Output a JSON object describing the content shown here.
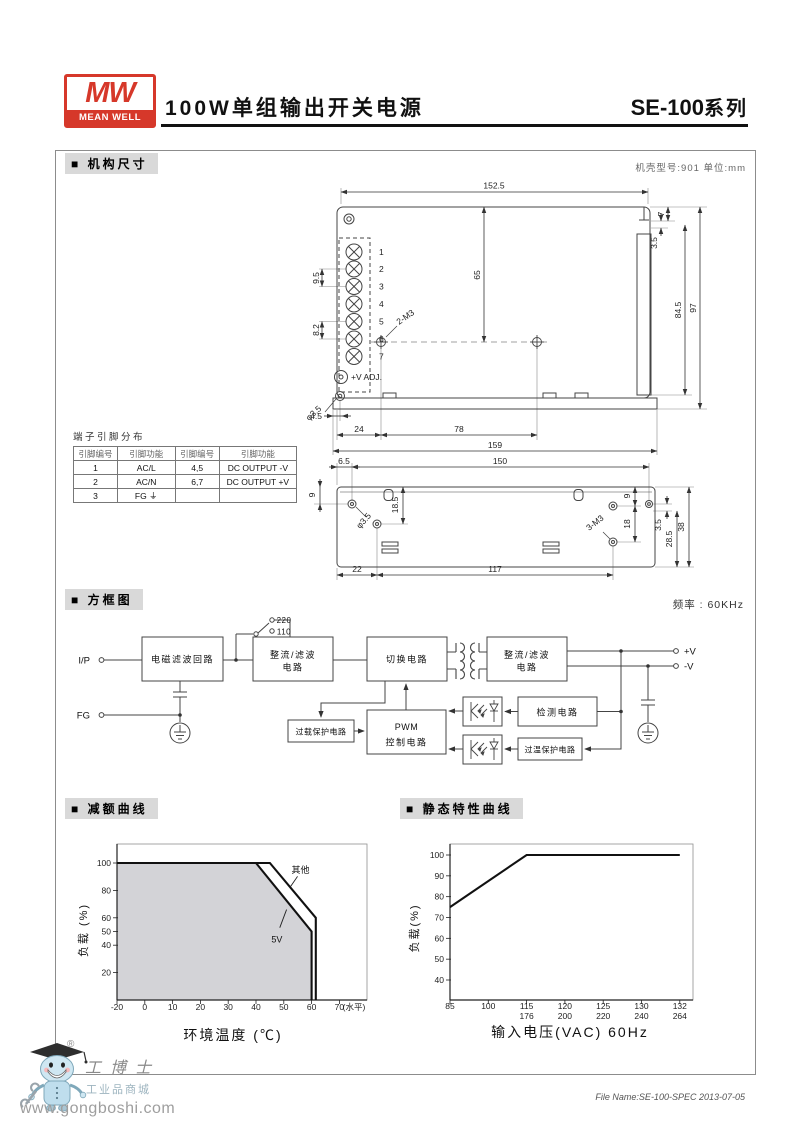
{
  "header": {
    "logo_mw": "MW",
    "logo_brand": "MEAN WELL",
    "logo_color": "#d6382a",
    "title": "100W单组输出开关电源",
    "series_model": "SE-100",
    "series_suffix": "系列"
  },
  "sections": {
    "mech": "■ 机构尺寸",
    "block": "■ 方框图",
    "derating": "■ 减额曲线",
    "static": "■ 静态特性曲线"
  },
  "mech": {
    "case_note": "机壳型号:901   单位:mm",
    "top_view": {
      "dims": {
        "w": "152.5",
        "h65": "65",
        "p95": "9.5",
        "p82": "8.2",
        "m45": "4.5",
        "m24": "24",
        "m78": "78",
        "m159": "159",
        "r7": "7",
        "r35": "3.5",
        "r845": "84.5",
        "r97": "97"
      },
      "labels": {
        "m3": "2-M3",
        "vadj": "+V ADJ.",
        "hole": "φ3.5"
      },
      "pins": [
        "1",
        "2",
        "3",
        "4",
        "5",
        "6",
        "7"
      ]
    },
    "pin_table": {
      "title": "端子引脚分布",
      "headers": [
        "引脚编号",
        "引脚功能",
        "引脚编号",
        "引脚功能"
      ],
      "rows": [
        [
          "1",
          "AC/L",
          "4,5",
          "DC OUTPUT -V"
        ],
        [
          "2",
          "AC/N",
          "6,7",
          "DC OUTPUT +V"
        ],
        [
          "3",
          "FG ⏚",
          "",
          ""
        ]
      ]
    },
    "side_view": {
      "dims": {
        "l65": "6.5",
        "w150": "150",
        "l9": "9",
        "l185": "18.5",
        "r9": "9",
        "r18": "18",
        "r35": "3.5",
        "r285": "28.5",
        "r38": "38",
        "b22": "22",
        "b117": "117"
      },
      "labels": {
        "hole": "φ3.5",
        "m3": "3-M3"
      }
    }
  },
  "block": {
    "frequency": "频率 : 60KHz",
    "sw_220": "220",
    "sw_110": "110",
    "t_ip": "I/P",
    "t_fg": "FG",
    "t_vp": "+V",
    "t_vm": "-V",
    "emi": "电磁滤波回路",
    "rect1a": "整流/滤波",
    "rect1b": "电路",
    "sw": "切换电路",
    "rect2a": "整流/滤波",
    "rect2b": "电路",
    "overload": "过载保护电路",
    "pwma": "PWM",
    "pwmb": "控制电路",
    "detect": "检测电路",
    "otp": "过温保护电路"
  },
  "chart_data": [
    {
      "type": "area",
      "title": "减额曲线",
      "xlabel": "环境温度 (℃)",
      "ylabel": "负载 (%)",
      "x_suffix": "(水平)",
      "xticks": [
        -20,
        0,
        10,
        20,
        30,
        40,
        50,
        60,
        70
      ],
      "yticks": [
        20,
        40,
        50,
        60,
        80,
        100
      ],
      "ylim": [
        0,
        100
      ],
      "grid": false,
      "legend_position": "inline",
      "series": [
        {
          "name": "5V",
          "points": [
            [
              -20,
              100
            ],
            [
              40,
              100
            ],
            [
              60,
              50
            ],
            [
              60,
              0
            ]
          ],
          "fill": "#d3d3d7"
        },
        {
          "name": "其他",
          "points": [
            [
              -20,
              100
            ],
            [
              45,
              100
            ],
            [
              61.5,
              60
            ],
            [
              61.5,
              0
            ]
          ],
          "fill": null
        }
      ],
      "annotations": [
        {
          "text": "其他",
          "x": 56,
          "y": 95,
          "tipx": 52.5,
          "tipy": 83
        },
        {
          "text": "5V",
          "x": 47.5,
          "y": 44,
          "tipx": 51,
          "tipy": 66
        }
      ]
    },
    {
      "type": "line",
      "title": "静态特性曲线",
      "xlabel": "输入电压(VAC) 60Hz",
      "ylabel": "负载(%)",
      "xticks": [
        85,
        100,
        115,
        120,
        125,
        130,
        132
      ],
      "xticks_sub": [
        "",
        "",
        "176",
        "200",
        "220",
        "240",
        "264"
      ],
      "yticks": [
        40,
        50,
        60,
        70,
        80,
        90,
        100
      ],
      "ylim": [
        40,
        100
      ],
      "grid": false,
      "series": [
        {
          "name": "负载",
          "points": [
            [
              85,
              75
            ],
            [
              115,
              100
            ],
            [
              132,
              100
            ]
          ],
          "fill": null
        }
      ],
      "annotations": []
    }
  ],
  "footer": {
    "file_name": "File Name:SE-100-SPEC   2013-07-05"
  },
  "watermark": {
    "reg": "®",
    "name": "工博士",
    "sub": "工业品商城",
    "url": "www.gongboshi.com"
  }
}
